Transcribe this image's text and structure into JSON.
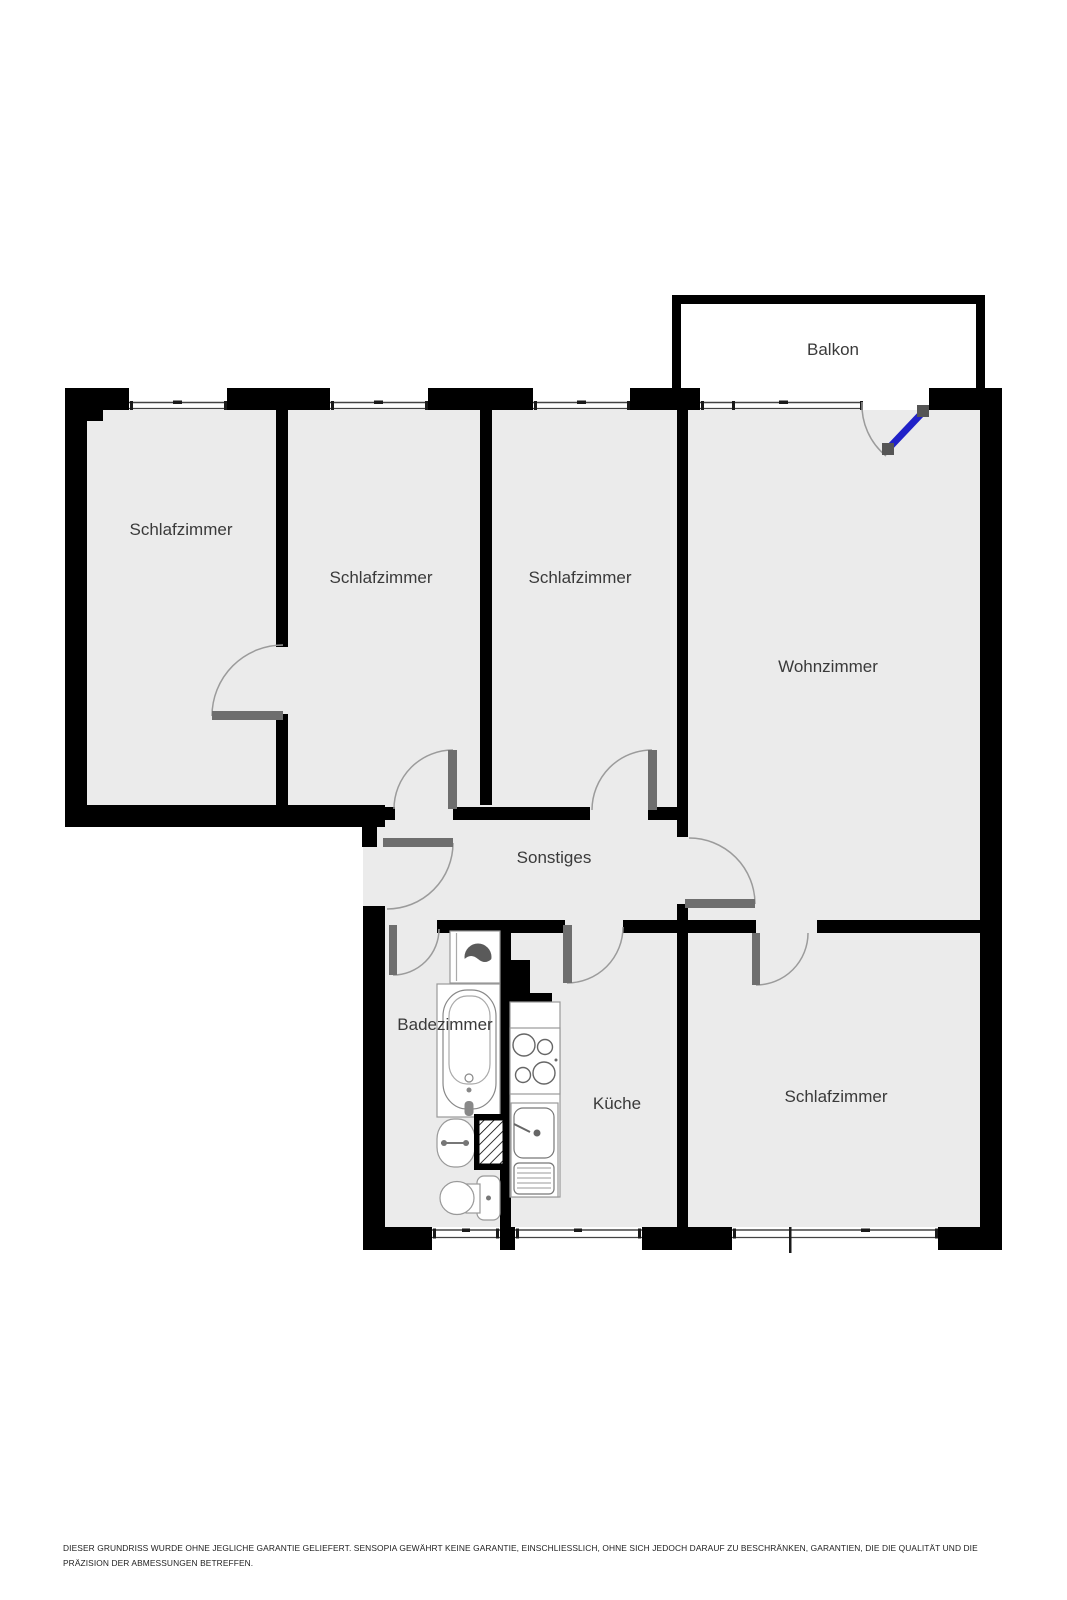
{
  "plan": {
    "rooms": [
      {
        "name": "bedroom-top-left",
        "label": "Schlafzimmer"
      },
      {
        "name": "bedroom-second",
        "label": "Schlafzimmer"
      },
      {
        "name": "bedroom-third",
        "label": "Schlafzimmer"
      },
      {
        "name": "living-room",
        "label": "Wohnzimmer"
      },
      {
        "name": "hallway",
        "label": "Sonstiges"
      },
      {
        "name": "bathroom",
        "label": "Badezimmer"
      },
      {
        "name": "kitchen",
        "label": "Küche"
      },
      {
        "name": "bedroom-bottom-right",
        "label": "Schlafzimmer"
      },
      {
        "name": "balcony",
        "label": "Balkon"
      }
    ],
    "colors": {
      "wall": "#000000",
      "floor": "#ebebeb",
      "door_leaf": "#6e6e6e",
      "door_arc": "#9b9b9b",
      "balcony_door": "#2021c8",
      "label_text": "#3a3a3a",
      "fixture_stroke": "#8a8a8a"
    }
  },
  "disclaimer": "DIESER GRUNDRISS WURDE OHNE JEGLICHE GARANTIE GELIEFERT. SENSOPIA GEWÄHRT KEINE GARANTIE, EINSCHLIESSLICH, OHNE SICH JEDOCH DARAUF ZU BESCHRÄNKEN, GARANTIEN, DIE DIE QUALITÄT UND DIE PRÄZISION DER ABMESSUNGEN BETREFFEN."
}
